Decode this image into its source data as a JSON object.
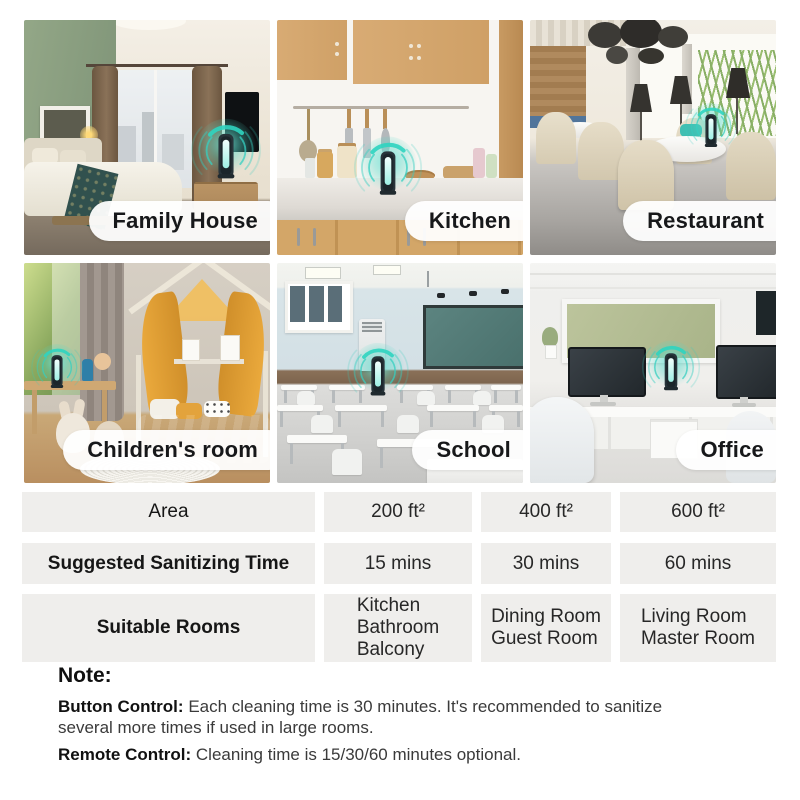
{
  "photos": [
    {
      "label": "Family House"
    },
    {
      "label": "Kitchen"
    },
    {
      "label": "Restaurant"
    },
    {
      "label": "Children's room"
    },
    {
      "label": "School"
    },
    {
      "label": "Office"
    }
  ],
  "table": {
    "rows": [
      {
        "label": "Area",
        "values": [
          "200 ft²",
          "400 ft²",
          "600 ft²"
        ]
      },
      {
        "label": "Suggested Sanitizing Time",
        "values": [
          "15 mins",
          "30 mins",
          "60 mins"
        ]
      },
      {
        "label": "Suitable Rooms",
        "values": [
          "Kitchen\nBathroom\nBalcony",
          "Dining Room\nGuest Room",
          "Living Room\nMaster Room"
        ]
      }
    ]
  },
  "note": {
    "title": "Note:",
    "items": [
      {
        "label": "Button Control:",
        "text": "Each cleaning time is 30 minutes. It's recommended to sanitize several more times if used in large rooms."
      },
      {
        "label": "Remote Control:",
        "text": "Cleaning time is 15/30/60 minutes optional."
      }
    ]
  },
  "icons": {
    "device": "uv-sanitizer-device-icon"
  },
  "colors": {
    "accent_teal": "#35cfc0",
    "table_row_bg": "#efeeec",
    "pill_bg": "#ffffff",
    "text_dark": "#1c1c1c"
  }
}
